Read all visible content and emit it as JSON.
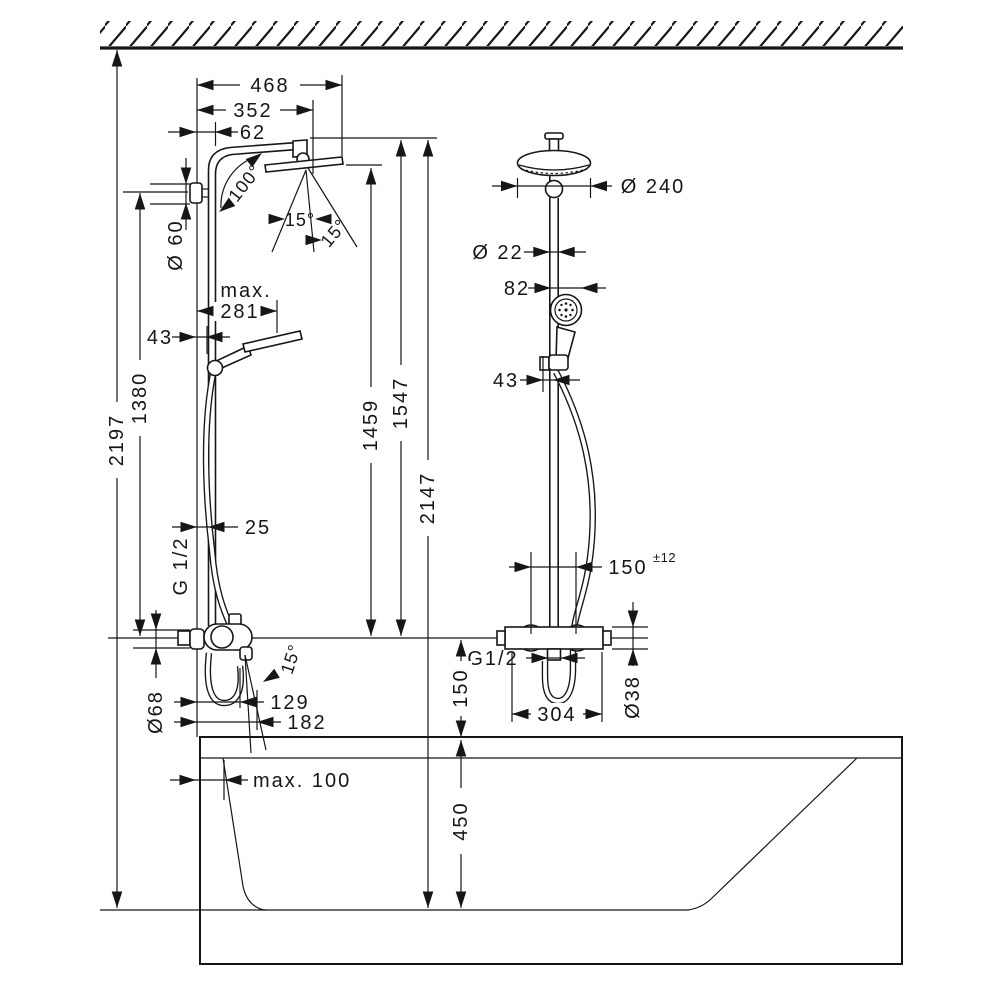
{
  "drawing": {
    "kind": "shower-system installation dimension diagram",
    "units_mm": true,
    "dims": {
      "left": {
        "d468": "468",
        "d352": "352",
        "d62": "62",
        "a100": "100°",
        "a15_1": "15°",
        "a15_2": "15°",
        "dia60": "Ø 60",
        "max_label": "max.",
        "d281": "281",
        "d43": "43",
        "d1380": "1380",
        "d2197": "2197",
        "d25": "25",
        "thread": "G 1/2",
        "a15_spout": "15°",
        "d129": "129",
        "d182": "182",
        "dia68": "Ø68",
        "d1459": "1459",
        "d1547": "1547",
        "d2147": "2147"
      },
      "right": {
        "dia240": "Ø 240",
        "dia22": "Ø 22",
        "d82": "82",
        "d43": "43",
        "d150h": "150",
        "d150h_tol": "±12",
        "thread": "G1/2",
        "d304": "304",
        "dia38": "Ø38",
        "d150v": "150"
      },
      "tub": {
        "max100": "max. 100",
        "d450": "450"
      }
    }
  }
}
